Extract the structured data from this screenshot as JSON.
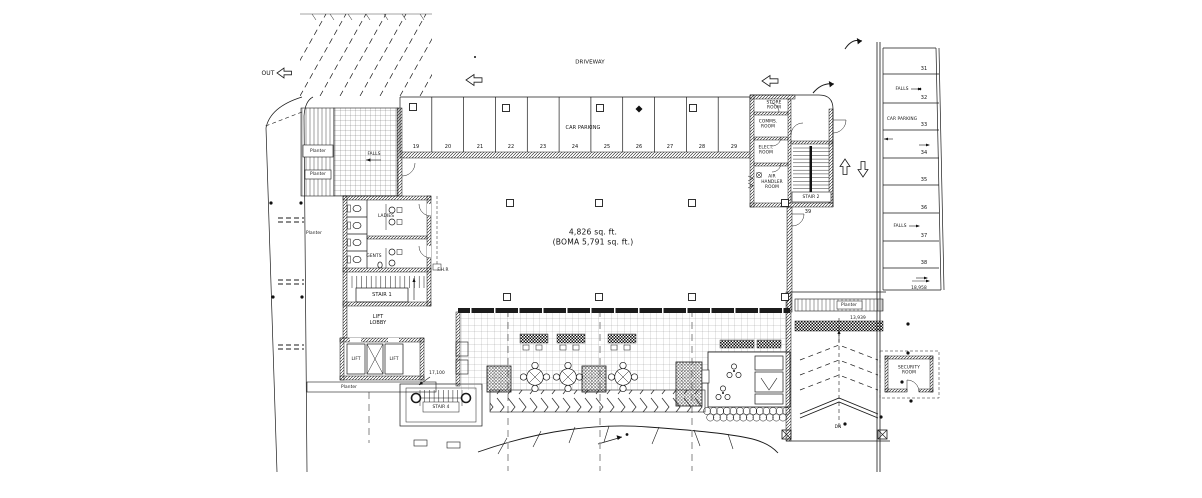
{
  "drawing": {
    "driveway": "DRIVEWAY",
    "out": "OUT",
    "dn": "DN",
    "area_label": {
      "line1": "4,826 sq. ft.",
      "line2": "(BOMA 5,791 sq. ft.)"
    },
    "rooms": {
      "store": "STORE\nROOM",
      "comms": "COMMS.\nROOM",
      "elect": "ELECT.\nROOM",
      "air_handler": "AIR\nHANDLER\nROOM",
      "security": "SECURITY\nROOM",
      "ladies": "LADIES",
      "gents": "GENTS",
      "lift_lobby": "LIFT\nLOBBY",
      "lift_left": "LIFT",
      "lift_right": "LIFT",
      "fhr": "F.H.R"
    },
    "stairs": {
      "stair1": "STAIR 1",
      "stair2": "STAIR 2",
      "stair4": "STAIR 4"
    },
    "planters": {
      "left_box": "Planter",
      "left_box2": "Planter",
      "road": "Planter",
      "lift": "Planter",
      "ramp": "Planter"
    },
    "falls": {
      "ramp": "FALLS",
      "right_upper": "FALLS",
      "right_lower": "FALLS"
    },
    "parking_top": {
      "label": "CAR PARKING",
      "stalls": [
        "19",
        "20",
        "21",
        "22",
        "23",
        "24",
        "25",
        "26",
        "27",
        "28",
        "29"
      ]
    },
    "parking_right": {
      "label": "CAR PARKING",
      "stalls": [
        "31",
        "32",
        "33",
        "34",
        "35",
        "36",
        "37",
        "38"
      ],
      "stall_39": "39"
    },
    "dimensions": {
      "d17100": "17,100",
      "d18958": "18,958",
      "d13939": "13,939"
    }
  }
}
